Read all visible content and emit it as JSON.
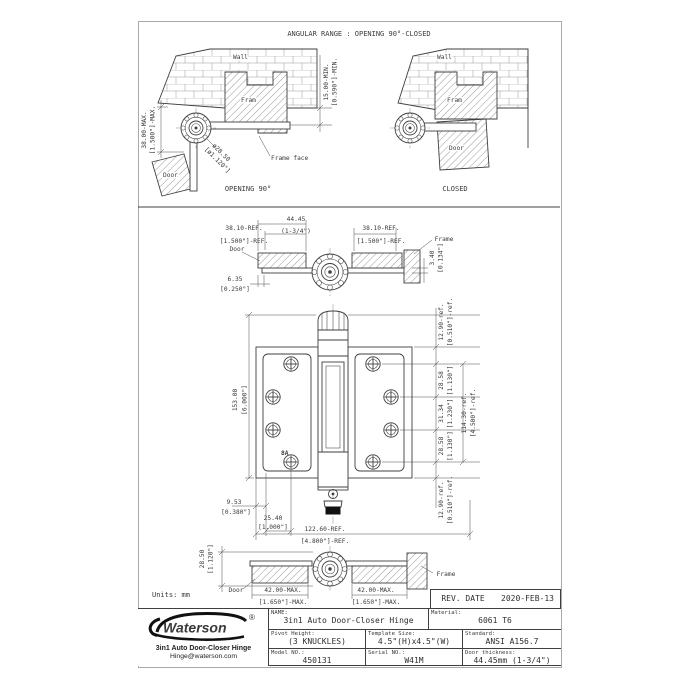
{
  "drawing": {
    "units_label": "Units: mm",
    "angular": {
      "title": "ANGULAR RANGE : OPENING 90°-CLOSED",
      "opening": {
        "caption": "OPENING 90°",
        "wall": "Wall",
        "frame": "Fram",
        "door": "Door",
        "frame_face": "Frame face",
        "dim_door_mm": "38.00-MAX.",
        "dim_door_in": "[1.500\"]-MAX.",
        "dim_dia_mm": "ø28.50",
        "dim_dia_in": "[ø1.120\"]",
        "dim_reveal_mm": "15.00-MIN.",
        "dim_reveal_in": "[0.590\"]-MIN."
      },
      "closed": {
        "caption": "CLOSED",
        "wall": "Wall",
        "frame": "Fram",
        "door": "Door"
      }
    },
    "top_view": {
      "door": "Door",
      "frame": "Frame",
      "dim_width_mm": "44.45",
      "dim_width_in": "(1-3/4\")",
      "dim_leaf_left_mm": "38.10-REF.",
      "dim_leaf_left_in": "[1.500\"]-REF.",
      "dim_leaf_right_mm": "38.10-REF.",
      "dim_leaf_right_in": "[1.500\"]-REF.",
      "dim_thk_mm": "3.40",
      "dim_thk_in": "[0.134\"]",
      "dim_inset_mm": "6.35",
      "dim_inset_in": "[0.250\"]"
    },
    "front_view": {
      "mark": "8A",
      "dim_height_mm": "153.00",
      "dim_height_in": "[6.000\"]",
      "dim_top_mm": "12.90-ref.",
      "dim_top_in": "[0.510\"]-ref.",
      "dim_p1_mm": "28.58",
      "dim_p1_in": "[1.130\"]",
      "dim_p2_mm": "31.34",
      "dim_p2_in": "[1.230\"]",
      "dim_p3_mm": "28.58",
      "dim_p3_in": "[1.130\"]",
      "dim_bot_mm": "12.90-ref.",
      "dim_bot_in": "[0.510\"]-ref.",
      "dim_span_mm": "114.30-ref.",
      "dim_span_in": "[4.500\"]-ref.",
      "dim_edge_mm": "9.53",
      "dim_edge_in": "[0.380\"]",
      "dim_col_mm": "25.40",
      "dim_col_in": "[1.000\"]",
      "dim_open_mm": "122.60-REF.",
      "dim_open_in": "[4.800\"]-REF."
    },
    "bottom_view": {
      "door": "Door",
      "frame": "Frame",
      "dim_dia_mm": "28.50",
      "dim_dia_in": "[1.120\"]",
      "dim_left_mm": "42.00-MAX.",
      "dim_left_in": "[1.650\"]-MAX.",
      "dim_right_mm": "42.00-MAX.",
      "dim_right_in": "[1.650\"]-MAX."
    }
  },
  "title_block": {
    "rev_date_label": "REV. DATE",
    "rev_date_value": "2020-FEB-13",
    "name_label": "NAME:",
    "name_value": "3in1 Auto Door-Closer Hinge",
    "material_label": "Material:",
    "material_value": "6061 T6",
    "pivot_label": "Pivot Height:",
    "pivot_value": "(3 KNUCKLES)",
    "template_label": "Template Size:",
    "template_value": "4.5\"(H)x4.5\"(W)",
    "standard_label": "Standard:",
    "standard_value": "ANSI A156.7",
    "model_label": "Model NO.:",
    "model_value": "450131",
    "serial_label": "Serial NO.:",
    "serial_value": "W41M",
    "thickness_label": "Door thickness:",
    "thickness_value": "44.45mm (1-3/4\")"
  },
  "logo": {
    "brand": "Waterson",
    "registered": "®",
    "tagline": "3in1 Auto Door-Closer Hinge",
    "email": "Hinge@waterson.com"
  },
  "colors": {
    "line": "#3f3f3f",
    "sheet_border": "#a9a9a9",
    "background": "#ffffff"
  }
}
